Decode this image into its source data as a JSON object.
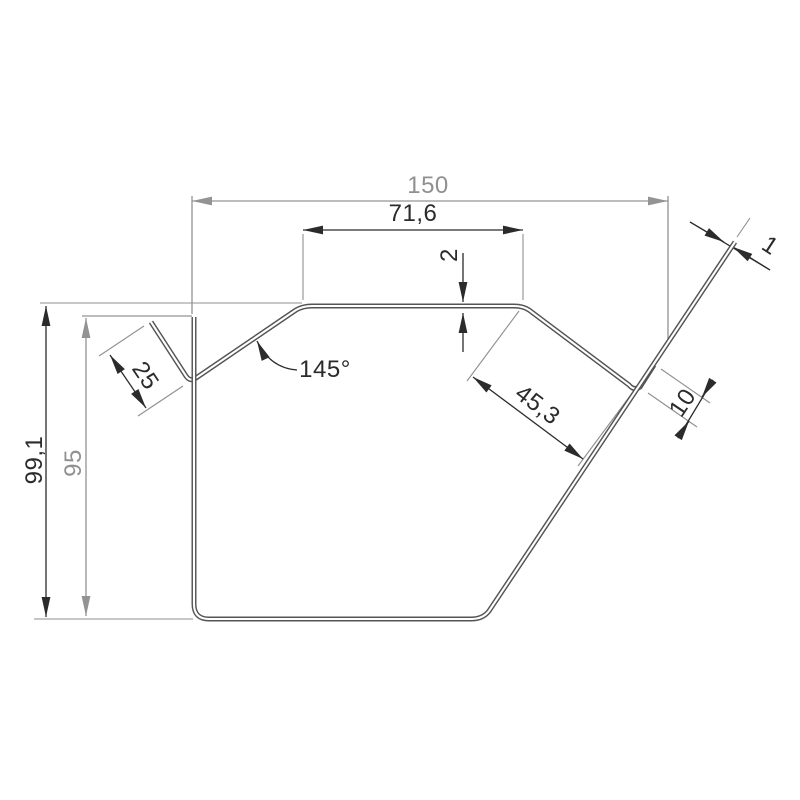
{
  "drawing": {
    "description": "Technical cross-section drawing of a bent sheet-metal coping profile with dimension callouts",
    "units": "mm",
    "dims": {
      "overall_width": "150",
      "top_flat_width": "71,6",
      "top_step": "2",
      "bend_angle": "145°",
      "left_flange_length": "25",
      "right_slope_length": "45,3",
      "hem_length": "10",
      "material_thickness": "1",
      "overall_height": "99,1",
      "left_wall_height": "95"
    },
    "colors": {
      "background": "#ffffff",
      "profile_line": "#545454",
      "dim_primary": "#2b2b2b",
      "dim_reference": "#909090",
      "extension_line": "#8f8f8f"
    }
  }
}
